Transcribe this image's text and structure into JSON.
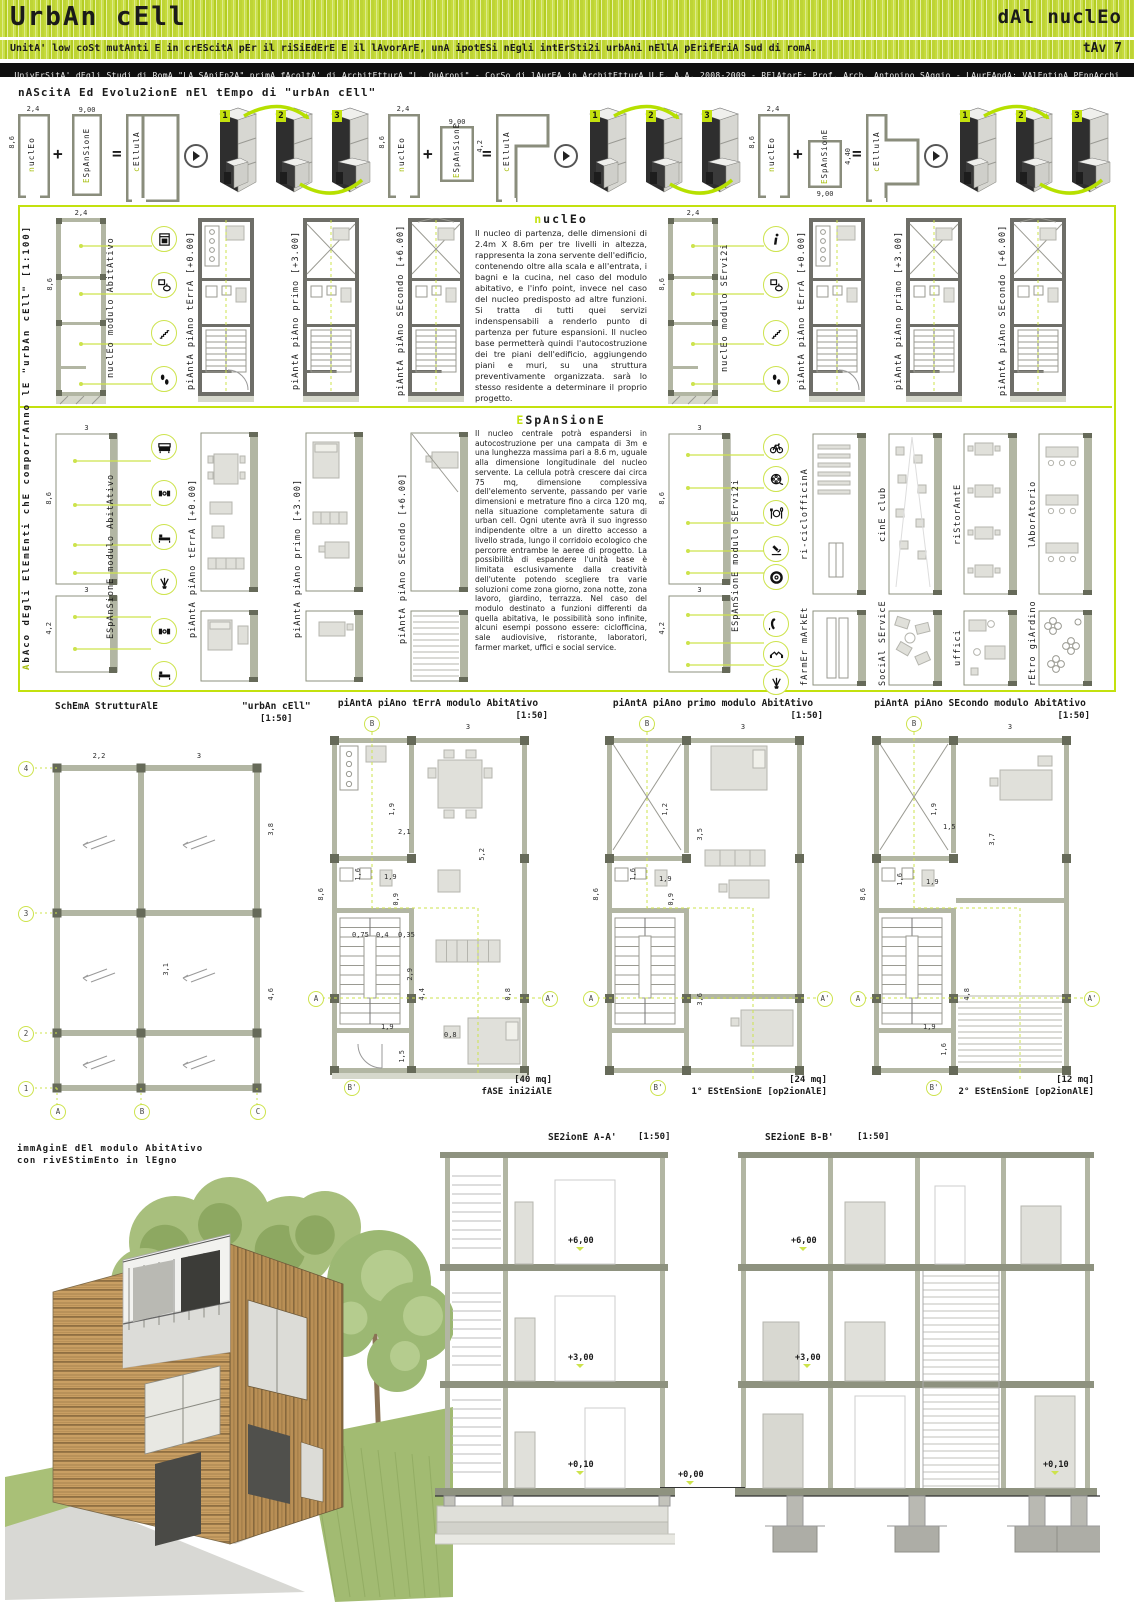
{
  "header": {
    "title": "UrbAn cEll",
    "right_title": "dAl nuclEo",
    "subtitle": "UnitA' low coSt mutAnti E in crEScitA pEr il riSiEdErE E il lAvorArE, unA ipotESi nEgli intErSti2i urbAni nEllA pErifEriA Sud di romA.",
    "tav": "tAv 7"
  },
  "uni_bar": "UnivErSitA' dEgli Studi di RomA \"LA SApiEn2A\" primA fAcoltA' di ArchitEtturA \"L. QuAroni\" - CorSo di lAurEA in ArchitEtturA U.E. A.A. 2008-2009 - RElAtorE: Prof. Arch. Antonino SAggio - LAurEAndA: VAlEntinA PEnnAcchi",
  "evolution": {
    "heading": "nAScitA Ed Evolu2ionE nEl tEmpo di \"urbAn cEll\"",
    "nucleo_label": "nuclEo",
    "espansione_label": "ESpAnSionE",
    "cellula_label": "cEllulA",
    "plus": "+",
    "equals": "=",
    "steps": [
      "1",
      "2",
      "3"
    ],
    "groups": [
      {
        "nucleo_w": "2,4",
        "nucleo_h": "8,6",
        "esp_dim_a": "9,00",
        "esp_dim_b": ""
      },
      {
        "nucleo_w": "2,4",
        "nucleo_h": "8,6",
        "esp_dim_a": "9,00",
        "esp_dim_b": "4,2"
      },
      {
        "nucleo_w": "2,4",
        "nucleo_h": "8,6",
        "esp_dim_a": "9,00",
        "esp_dim_b": "4,40"
      }
    ]
  },
  "sidebar": {
    "full_label": "AbAco  dEgli  ElEmEnti  chE  comporrAnno    lE  \"urbAn  cEll\"      [1:100]"
  },
  "nucleo": {
    "heading": "nuclEo",
    "body": "Il nucleo di partenza, delle dimensioni di 2.4m X 8.6m per tre livelli in altezza, rappresenta la zona servente dell'edificio, contenendo oltre alla scala e all'entrata, i bagni e la cucina, nel caso del modulo abitativo, e l'info point, invece nel caso del nucleo predisposto ad altre funzioni. Si tratta di tutti quei servizi indenspensabili a renderlo punto di partenza per future espansioni. Il nucleo base permetterà quindi l'autocostruzione dei tre piani dell'edificio, aggiungendo piani e muri, su una struttura preventivamente organizzata. sarà lo stesso residente a determinare il proprio progetto.",
    "abitativo": {
      "module_label": "nuclEo modulo AbitAtivo",
      "dim_w": "2,4",
      "dim_h": "8,6",
      "icons": [
        "kitchen-icon",
        "bathroom-icon",
        "stairs-icon",
        "footprints-icon"
      ],
      "plans": [
        "piAntA piAno tErrA [+0.00]",
        "piAntA piAno primo [+3.00]",
        "piAntA piAno SEcondo [+6.00]"
      ]
    },
    "servizi": {
      "module_label": "nuclEo modulo SErvi2i",
      "dim_w": "2,4",
      "dim_h": "8,6",
      "icons": [
        "info-icon",
        "bathroom-icon",
        "stairs-icon",
        "footprints-icon"
      ],
      "plans": [
        "piAntA piAno tErrA [+0.00]",
        "piAntA piAno primo [+3.00]",
        "piAntA piAno SEcondo [+6.00]"
      ]
    }
  },
  "espansione": {
    "heading": "ESpAnSionE",
    "body": "Il nucleo centrale potrà espandersi in autocostruzione per una campata di 3m e una lunghezza massima pari a 8.6 m, uguale alla dimensione longitudinale del nucleo servente. La cellula potrà crescere dai circa 75 mq, dimensione complessiva dell'elemento servente, passando per varie dimensioni e metrature fino a circa 120 mq, nella situazione completamente satura di urban cell. Ogni utente avrà il suo ingresso indipendente oltre a un diretto accesso a livello strada, lungo il corridoio ecologico che percorre entrambe le aeree di progetto. La possibilità di espandere l'unità base è limitata esclusivamente dalla creatività dell'utente potendo scegliere tra varie soluzioni come zona giorno, zona notte, zona lavoro, giardino, terrazza. Nel caso del modulo destinato a funzioni differenti da quella abitativa, le possibilità sono infinite, alcuni esempi possono essere: ciclofficina, sale audiovisive, ristorante, laboratori, farmer market, uffici e social service.",
    "abitativo": {
      "module_label": "ESpAnSionE modulo AbitAtivo",
      "dim_w": "3",
      "dim_h1": "8,6",
      "dim_h2": "4,2",
      "icons": [
        "sofa-icon",
        "chairs-icon",
        "bed-icon",
        "plant-icon",
        "chairs-icon",
        "bed-icon"
      ],
      "plans": [
        "piAntA piAno tErrA [+0.00]",
        "piAntA piAno primo [+3.00]",
        "piAntA piAno SEcondo [+6.00]"
      ]
    },
    "servizi": {
      "module_label": "ESpAnSionE modulo SErvi2i",
      "dim_w": "3",
      "dim_h1": "8,6",
      "dim_h2": "4,2",
      "icons": [
        "bicycle-icon",
        "film-icon",
        "restaurant-icon",
        "microscope-icon",
        "tire-icon",
        "phone-icon",
        "handshake-icon",
        "plant-icon"
      ],
      "services": [
        "ri-ciclofficinA",
        "cinE club",
        "riStorAntE",
        "lAborAtorio",
        "fArmEr mArkEt",
        "SociAl SErvicE",
        "uffici",
        "rEtro giArdino"
      ]
    }
  },
  "schema": {
    "title": "SchEmA StrutturAlE",
    "subtitle": "\"urbAn cEll\"",
    "scale": "[1:50]",
    "row_axes": [
      "4",
      "3",
      "2",
      "1"
    ],
    "col_axes": [
      "A",
      "B",
      "C"
    ],
    "dim_top": [
      "2,2",
      "3"
    ],
    "dim_right": [
      "3,8",
      "4,6"
    ],
    "dim_inner": "3,1"
  },
  "plans": {
    "markers": {
      "a": "A",
      "a1": "A'",
      "b": "B",
      "b1": "B'"
    },
    "terra": {
      "title": "piAntA piAno tErrA  modulo AbitAtivo",
      "scale": "[1:50]",
      "dim_top": [
        "2,2",
        "3"
      ],
      "dim_left": "8,6",
      "dims": [
        "1,9",
        "2,1",
        "5,2",
        "1,6",
        "1,9",
        "0,9",
        "0,75",
        "0,4",
        "0,35",
        "2,9",
        "4,4",
        "1,9",
        "0,8",
        "0,8",
        "1,5"
      ],
      "area": "[40 mq]",
      "phase": "fASE ini2iAlE"
    },
    "primo": {
      "title": "piAntA piAno primo  modulo AbitAtivo",
      "scale": "[1:50]",
      "dim_top": [
        "2,2",
        "3"
      ],
      "dim_left": "8,6",
      "dims": [
        "1,2",
        "3,5",
        "1,6",
        "1,9",
        "0,9",
        "3,6"
      ],
      "area": "[24 mq]",
      "phase": "1° EStEnSionE [op2ionAlE]"
    },
    "secondo": {
      "title": "piAntA piAno SEcondo modulo AbitAtivo",
      "scale": "[1:50]",
      "dim_top": [
        "2,2",
        "3"
      ],
      "dim_left": "8,6",
      "dims": [
        "1,9",
        "1,5",
        "3,7",
        "1,6",
        "1,9",
        "4,8",
        "1,9",
        "1,6"
      ],
      "area": "[12 mq]",
      "phase": "2° EStEnSionE [op2ionAlE]"
    }
  },
  "render_caption": {
    "line1": "immAginE dEl modulo AbitAtivo",
    "line2": "con rivEStimEnto in lEgno"
  },
  "sections": {
    "a": {
      "title": "SE2ionE A-A'",
      "scale": "[1:50]",
      "levels": [
        "+6,00",
        "+3,00",
        "+0,10"
      ]
    },
    "b": {
      "title": "SE2ionE B-B'",
      "scale": "[1:50]",
      "levels": [
        "+6,00",
        "+3,00",
        "+0,10"
      ]
    },
    "ground": "+0,00"
  }
}
